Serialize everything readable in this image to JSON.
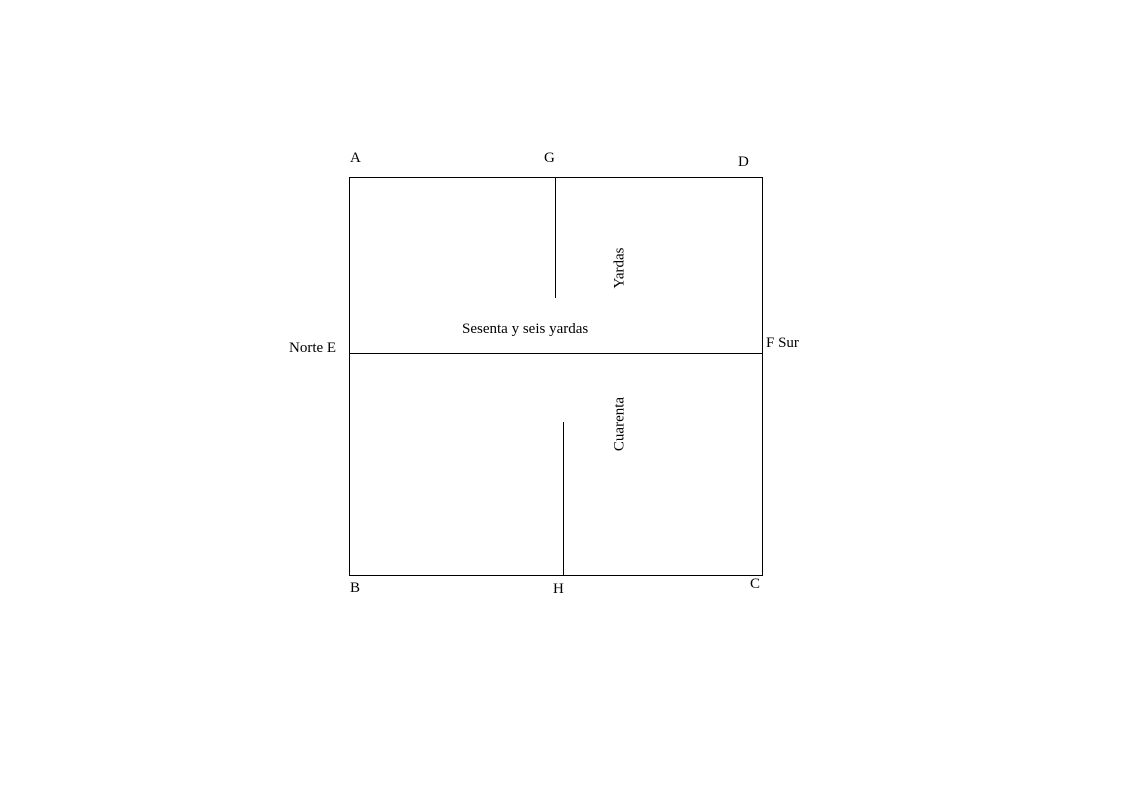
{
  "diagram": {
    "labels": {
      "a": "A",
      "g": "G",
      "d": "D",
      "b": "B",
      "h": "H",
      "c": "C",
      "norte_e": "Norte E",
      "f_sur": "F Sur",
      "sesenta": "Sesenta y seis yardas",
      "yardas": "Yardas",
      "cuarenta": "Cuarenta"
    },
    "colors": {
      "background": "#ffffff",
      "line": "#000000",
      "text": "#000000"
    }
  }
}
